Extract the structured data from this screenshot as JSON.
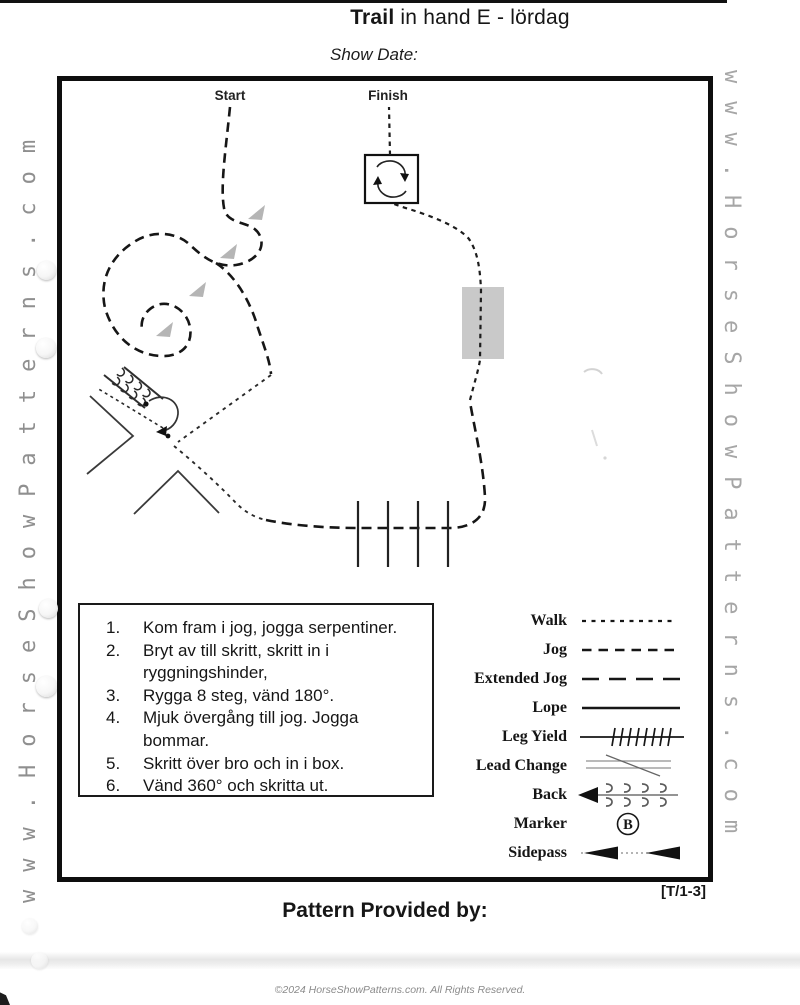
{
  "page": {
    "title_bold": "Trail",
    "title_rest": " in hand E - lördag",
    "show_date": "Show Date:",
    "pattern_code": "[T/1-3]",
    "provided_by": "Pattern Provided by:",
    "copyright": "©2024 HorseShowPatterns.com. All Rights Reserved."
  },
  "watermarks": {
    "left": "www.HorseShowPatterns.com",
    "right": "www.HorseShowPatterns.com"
  },
  "course": {
    "start": "Start",
    "finish": "Finish"
  },
  "instructions": {
    "rows": [
      {
        "n": "1.",
        "t": "Kom fram i jog, jogga serpentiner."
      },
      {
        "n": "2.",
        "t": "Bryt av till skritt, skritt in i"
      },
      {
        "n": "",
        "t": "ryggningshinder,"
      },
      {
        "n": "3.",
        "t": "Rygga 8 steg, vänd 180°."
      },
      {
        "n": "4.",
        "t": "Mjuk övergång till jog. Jogga"
      },
      {
        "n": "",
        "t": "bommar."
      },
      {
        "n": "5.",
        "t": "Skritt över bro och in i box."
      },
      {
        "n": "6.",
        "t": "Vänd 360° och skritta ut."
      }
    ]
  },
  "legend": {
    "rows": [
      {
        "label": "Walk"
      },
      {
        "label": "Jog"
      },
      {
        "label": "Extended Jog"
      },
      {
        "label": "Lope"
      },
      {
        "label": "Leg Yield"
      },
      {
        "label": "Lead Change"
      },
      {
        "label": "Back"
      },
      {
        "label": "Marker"
      },
      {
        "label": "Sidepass"
      }
    ],
    "marker_letter": "B"
  },
  "colors": {
    "ink": "#161616",
    "bridge_gray": "#c9c9c9",
    "direction_arrow_gray": "#b5b5b5",
    "watermark_gray": "#8f8f8f"
  }
}
